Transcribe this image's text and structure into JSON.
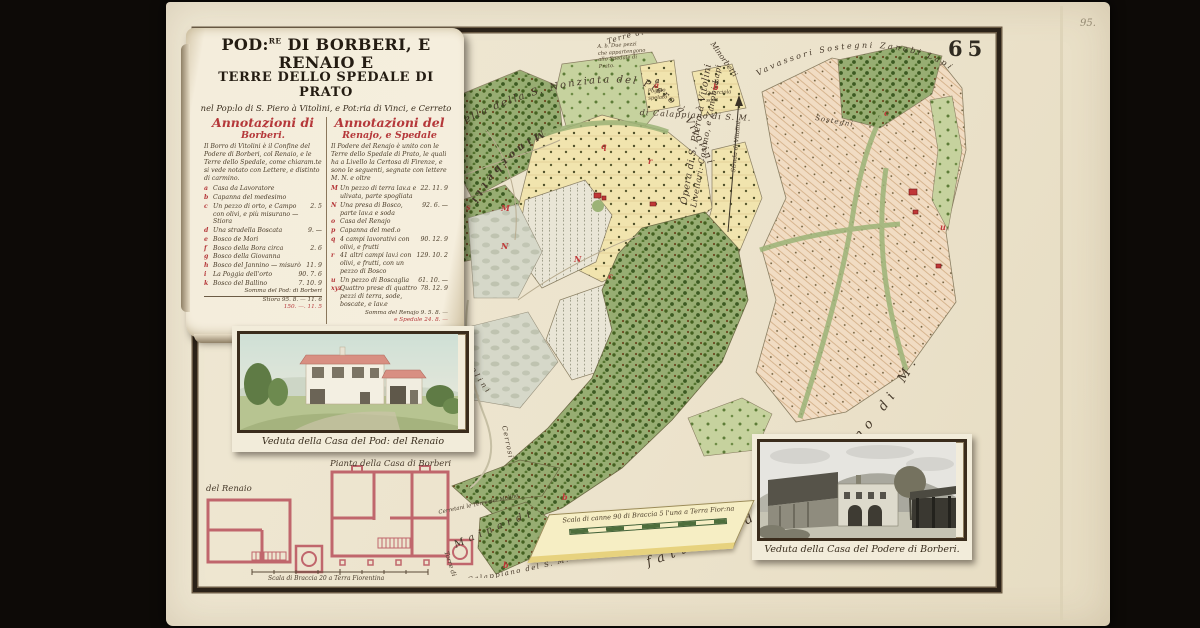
{
  "page": {
    "plate": "65",
    "folio": "95."
  },
  "colors": {
    "carmine": "#b5383a",
    "ink": "#3f3527",
    "paper": "#ece4cf",
    "woods": "#97ad72",
    "fields": "#f1e4ae",
    "vineyard_pink": "#f1dcc3"
  },
  "cartouche": {
    "title1a": "POD:",
    "title1sup": "RE",
    "title1b": " DI BORBERI, E RENAIO E",
    "title2": "TERRE DELLO SPEDALE DI PRATO",
    "title3": "nel Pop:lo di S. Piero à Vitolini, e Pot:ria di Vinci, e Cerreto",
    "left": {
      "head1": "Annotazioni di",
      "head2": "Borberi.",
      "intro": "Il Borro di Vitolini è il Confine del Podere di Borberi, col Renaio, e le Terre dello Spedale, come chiaram.te si vede notato con Lettere, e distinto di carmino.",
      "items": [
        {
          "letter": "a",
          "text": "Casa da Lavoratore",
          "value": ""
        },
        {
          "letter": "b",
          "text": "Capanna del medesimo",
          "value": ""
        },
        {
          "letter": "c",
          "text": "Un pezzo di orto, e Campo con olivi, e più misurano — Stiora",
          "value": "2. 5"
        },
        {
          "letter": "d",
          "text": "Una stradella Boscata",
          "value": "9. —"
        },
        {
          "letter": "e",
          "text": "Bosco de Mori",
          "value": ""
        },
        {
          "letter": "f",
          "text": "Bosco della Bora circa",
          "value": "2. 6"
        },
        {
          "letter": "g",
          "text": "Bosco della Giovanna",
          "value": ""
        },
        {
          "letter": "h",
          "text": "Bosco del Jannino — misurò",
          "value": "11. 9"
        },
        {
          "letter": "i",
          "text": "La Poggia dell'orto",
          "value": "90. 7. 6"
        },
        {
          "letter": "k",
          "text": "Bosco del Ballino",
          "value": "7. 10. 9"
        }
      ],
      "totals": [
        "Somma del Pod: di Borberi",
        "Stiora 95. 8. — 11. 6",
        "150. —. 11. 5"
      ]
    },
    "right": {
      "head1": "Annotazioni del",
      "head2": "Renajo, e Spedale",
      "intro": "Il Podere del Renajo è unito con le Terre dello Spedale di Prato, le quali ha a Livello la Certosa di Firenze, e sono le seguenti, segnate con lettere M. N. e oltre",
      "items": [
        {
          "letter": "M",
          "text": "Un pezzo di terra lav.a e ulivata, parte spogliata",
          "value": "22. 11. 9"
        },
        {
          "letter": "N",
          "text": "Una presa di Bosco, parte lav.a e soda",
          "value": "92. 6. —"
        },
        {
          "letter": "o",
          "text": "Casa del Renajo",
          "value": ""
        },
        {
          "letter": "p",
          "text": "Capanna del med.o",
          "value": ""
        },
        {
          "letter": "q",
          "text": "4 campi lavorativi con olivi, e frutti",
          "value": "90. 12. 9"
        },
        {
          "letter": "r",
          "text": "41 altri campi lav.i con olivi, e frutti, con un pezzo di Bosco",
          "value": "129. 10. 2"
        },
        {
          "letter": "u",
          "text": "Un pezzo di Boscaglia",
          "value": "61. 10. —"
        },
        {
          "letter": "xyz",
          "text": "Quattro prese di quattro pezzi di terra, sode, boscate, e lav.e",
          "value": "78. 12. 9"
        }
      ],
      "totals": [
        "Somma del Renajo 9. 5. 8. —",
        "e Spedale 24. 8. —"
      ]
    },
    "footer1": "Somma in tutto le due tenute — 475. 12. 5",
    "footer2": "Misurò, e disegnò l'Anno 1787."
  },
  "map": {
    "labels": {
      "terre_top": "Terre di Calappiano di Sotto",
      "note_ab_1": "A. b. Due pezzi",
      "note_ab_2": "che appartengono",
      "note_ab_3": "allo Spedale di",
      "note_ab_4": "Prato.",
      "parcel_a": "a",
      "parcel_a_note_1": "Poggio",
      "parcel_a_note_2": "spelato",
      "parcel_b": "b",
      "parcel_b_note_1": "Querciola",
      "parcel_b_note_2": "soda",
      "calappiano_sm": "di Calappiano di S. M.",
      "lamporiali": "delli Lamporiali Sostegni",
      "cappella": "Cappella della S. Nonziata del Piero à Vitolini",
      "vavassori": "Vavassori Sostegni Zanobi Lapi",
      "minorbetti_road": "Minorbetti",
      "minorbetti_small": "Minorbetti",
      "sostegni": "Sostegni",
      "opera_1": "Opera di S. Piero à Vitolini",
      "opera_2": "Livellari: Cosimo, e Zanobi Lapi",
      "strada_arrow": "Strada di Vitolini",
      "borro": "Borro di Vitolini",
      "mainardi": "Mainardi",
      "cerrosi": "Cerrosi",
      "cerretani": "Cerretani le Terre del Molino",
      "torre_di": "Torre di",
      "calappiano_bottom": "Calappiano del S. M.",
      "fattoria": "fattoria di Calappiano di M."
    },
    "letters": [
      {
        "ch": "a"
      },
      {
        "ch": "b"
      },
      {
        "ch": "q"
      },
      {
        "ch": "r"
      },
      {
        "ch": "s"
      },
      {
        "ch": "M"
      },
      {
        "ch": "N"
      },
      {
        "ch": "N"
      },
      {
        "ch": "c"
      },
      {
        "ch": "c"
      },
      {
        "ch": "b"
      },
      {
        "ch": "b"
      },
      {
        "ch": "u"
      }
    ],
    "scale_caption": "Scala di canne 90 di Braccia 5 l'una a Terra Fior:na"
  },
  "insets": {
    "renaio_view_caption": "Veduta della Casa del Pod: del Renaio",
    "borberi_view_caption": "Veduta della Casa del Podere di Borberi.",
    "plan_left_label": "del Renaio",
    "plan_right_label": "Pianta della Casa di Borberi",
    "plan_scale_caption": "Scala di Braccia 20 a Terra Fiorentina"
  }
}
